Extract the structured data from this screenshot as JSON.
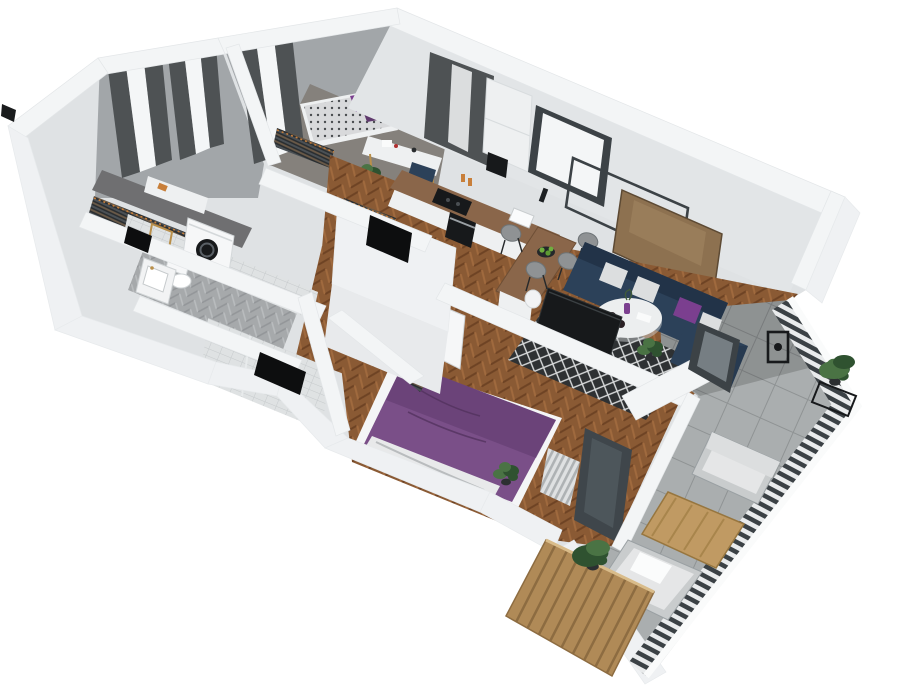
{
  "scene": {
    "title": "3D apartment floor plan render",
    "description": "Isometric cutaway 3D render of a furnished apartment with balcony terrace, viewed from above at an angle, on a white background. No text labels are visible.",
    "rooms": [
      {
        "name": "Bedroom 1",
        "floor": "dark gray",
        "items": [
          "two tall windows with dark gray curtains and white blinds",
          "open wardrobe rack with hanging clothes",
          "white shelf with orange box"
        ]
      },
      {
        "name": "Bedroom 2",
        "floor": "gray",
        "items": [
          "bed with patterned duvet and purple pillows",
          "white desk with gold legs",
          "navy bean bag",
          "potted plant",
          "open wardrobe with hanging clothes",
          "window with dark curtains"
        ]
      },
      {
        "name": "Bathroom",
        "floor": "gray herringbone tile",
        "items": [
          "washing machine with round black door",
          "toilet",
          "white vanity sink with gold faucet",
          "gold framed mirror",
          "white tiled walls",
          "dark service shaft"
        ]
      },
      {
        "name": "Shower room",
        "floor": "gray tile",
        "items": [
          "light gray tiled walls",
          "dark shower tray"
        ]
      },
      {
        "name": "Hallway",
        "floor": "wood herringbone parquet",
        "items": [
          "walk-in closet with hanging clothes and dark opening",
          "white interior doors"
        ]
      },
      {
        "name": "Kitchen",
        "floor": "wood herringbone parquet",
        "items": [
          "white cabinets with wood countertop",
          "black cooktop",
          "black oven",
          "white sink",
          "coffee machine",
          "tall white cabinet",
          "bowl of green apples",
          "four gray bar stools at peninsula",
          "white trash bin",
          "dark framed window",
          "glass door with dark curtains",
          "juice glasses"
        ]
      },
      {
        "name": "Living room",
        "floor": "wood herringbone parquet",
        "items": [
          "navy corner sofa",
          "white gray and purple cushions",
          "round white coffee table with purple vase and candles",
          "black and white diamond pattern rug",
          "wall mounted TV",
          "empty black picture frame",
          "wood panel picture",
          "potted plant",
          "dark framed balcony door"
        ]
      },
      {
        "name": "Master bedroom",
        "floor": "wood herringbone parquet",
        "items": [
          "double bed with purple duvet and white sheets",
          "open wardrobe with hanging clothes",
          "open white door",
          "potted plant",
          "anthracite framed balcony door",
          "white slat radiator"
        ]
      },
      {
        "name": "Balcony terrace",
        "floor": "gray concrete tiles",
        "items": [
          "dark slat railing with white handrail",
          "black lantern",
          "plant on black metal stand",
          "outdoor armchair with white cushions",
          "wooden coffee table",
          "outdoor lounger with white cushion",
          "wooden slat privacy screen",
          "leafy potted plant"
        ]
      }
    ],
    "palette": {
      "bg": "#ffffff",
      "wall_cap": "#f3f5f6",
      "wall_outer_white": "#eff1f3",
      "wall_face_light": "#e2e5e7",
      "wall_face_mid": "#c7cbce",
      "wall_face_dark": "#a2a6a9",
      "floor_wood": "#8a5a34",
      "floor_wood_dark": "#6e4324",
      "floor_wood_light": "#a06a3e",
      "floor_gray": "#85817c",
      "floor_bath": "#a6a9ab",
      "floor_balcony": "#aaaeaf",
      "tile_wall": "#dfe2e3",
      "curtain": "#4e5254",
      "window_glass": "#f4f6f7",
      "frame_dark": "#3c4246",
      "clothes_dark": "#2a2e31",
      "hanger_orange": "#c87f3a",
      "bed_purple": "#7a4f88",
      "bed_purple_dark": "#5f3a6d",
      "sheet_white": "#e8e9ea",
      "duvet_gray": "#d8d9db",
      "sofa_navy": "#2c4159",
      "sofa_navy_dark": "#223348",
      "pillow_white": "#dcdedf",
      "pillow_purple": "#7b3f8f",
      "rug_dark": "#2e3133",
      "rug_light": "#d8dadb",
      "table_white": "#eceeef",
      "counter_wood": "#8a664a",
      "cabinet_white": "#eef0f1",
      "appliance_black": "#17191b",
      "stool_gray": "#8f9294",
      "plant_green": "#4a7344",
      "plant_green_dark": "#2f5230",
      "wood_screen": "#b08a57",
      "wood_screen_dark": "#8d6c41",
      "terrace_wood": "#c09a63",
      "cushion_white": "#e5e6e7",
      "door_anthracite": "#3f464b",
      "gold": "#b98f4a"
    }
  }
}
